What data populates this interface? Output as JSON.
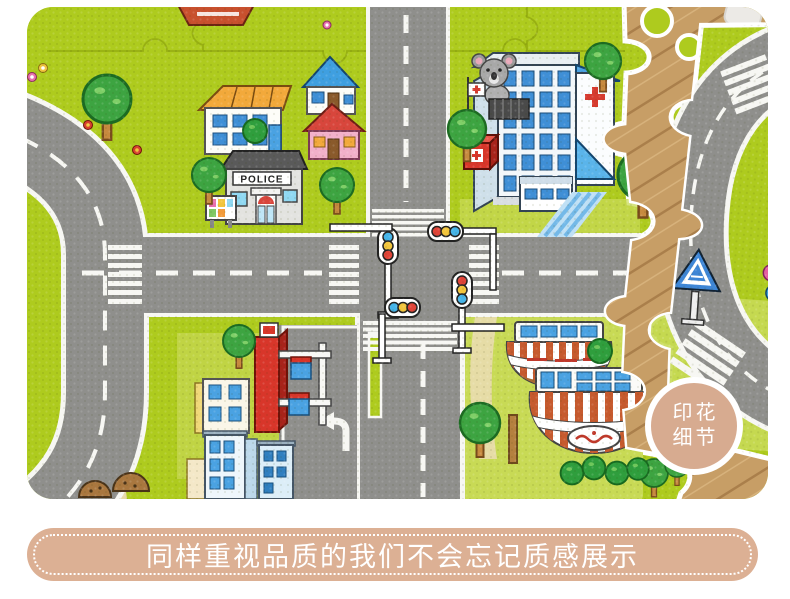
{
  "page": {
    "background": "#ffffff"
  },
  "photo": {
    "description": "Partially assembled children's foam puzzle play mat printed with a city traffic map, lying on a wooden floor",
    "badge": {
      "line1": "印花",
      "line2": "细节"
    },
    "scene": {
      "police_label": "POLICE",
      "elements": [
        "city-play-mat",
        "ring-road",
        "crossroads",
        "zebra-crossings",
        "traffic-lights",
        "police-station",
        "hospital",
        "houses",
        "gas-station",
        "striped-awning-shops",
        "trees",
        "flowers",
        "koala",
        "first-aid-box",
        "pedestrian-crossing-sign",
        "loose-puzzle-pieces",
        "wooden-floor"
      ],
      "colors": {
        "mat_green": "#aecb1e",
        "mat_green_light": "#c8da55",
        "road_gray": "#8f8f8c",
        "marking_white": "#f7f7f3",
        "wood_floor": "#c79e66",
        "path_beige": "#e7d9a8",
        "hospital_blue": "#4aa2e2",
        "cross_red": "#d63b2f",
        "roof_orange": "#f2a93b",
        "roof_blue": "#3f9fe0",
        "roof_red": "#d8463c",
        "house_pink": "#f2b0ca",
        "awning_red": "#c65a2e",
        "tree_green": "#3da441",
        "trunk_brown": "#c78a3f",
        "badge_tan": "#d7ab90",
        "caption_tan": "#dcb094"
      }
    }
  },
  "caption": {
    "text": "同样重视品质的我们不会忘记质感展示"
  }
}
